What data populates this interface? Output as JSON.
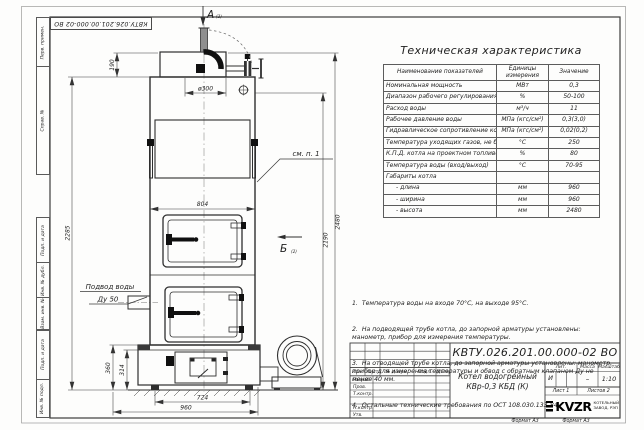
{
  "sheet": {
    "doc_number": "КВТУ.026.201.00.000-02  ВО",
    "format_label_1": "Формат А3",
    "format_label_2": "Формат А3",
    "margin_fields": [
      "Перв. примен.",
      "Справ. №",
      "Подп. и дата",
      "Инв. № дубл.",
      "Взам. инв. №",
      "Подп. и дата",
      "Инв. № подл."
    ]
  },
  "drawing": {
    "view_a_label": "А",
    "view_a_ref": "(2)",
    "view_b_label": "Б",
    "view_b_ref": "(2)",
    "callout": "см. п. 1",
    "water_inlet": {
      "line1": "Подвод воды",
      "line2": "Ду 50"
    },
    "dims": {
      "chimney_offset": "190",
      "flue_diameter": "ø300",
      "body_width": "804",
      "height_left": "2285",
      "height_total": "2480",
      "height_to_flue": "2190",
      "base_height": "360",
      "base_inner": "314",
      "base_width": "724",
      "depth": "960"
    }
  },
  "spec": {
    "title": "Техническая характеристика",
    "col_name": "Наименование показателей",
    "col_units": "Единицы измерения",
    "col_value": "Значение",
    "rows": [
      {
        "name": "Номинальная мощность",
        "units": "МВт",
        "value": "0,3"
      },
      {
        "name": "Диапазон рабочего регулирования",
        "units": "%",
        "value": "50-100"
      },
      {
        "name": "Расход воды",
        "units": "м³/ч",
        "value": "11"
      },
      {
        "name": "Рабочее давление воды",
        "units": "МПа (кгс/см²)",
        "value": "0,3(3,0)"
      },
      {
        "name": "Гидравлическое сопротивление котла",
        "units": "МПа (кгс/см²)",
        "value": "0,02(0,2)"
      },
      {
        "name": "Температура уходящих газов, не более",
        "units": "°С",
        "value": "250"
      },
      {
        "name": "К.П.Д. котла на проектном топливе",
        "units": "%",
        "value": "80"
      },
      {
        "name": "Температура воды (вход/выход)",
        "units": "°С",
        "value": "70-95"
      },
      {
        "name": "Габариты котла",
        "units": "",
        "value": ""
      },
      {
        "name": "- длина",
        "units": "мм",
        "value": "960"
      },
      {
        "name": "- ширина",
        "units": "мм",
        "value": "960"
      },
      {
        "name": "- высота",
        "units": "мм",
        "value": "2480"
      }
    ]
  },
  "notes": [
    "1.  Температура воды на входе 70°С, на выходе 95°С.",
    "2.  На подводящей трубе котла, до запорной арматуры установлены: манометр, прибор для измерения температуры.",
    "3.  На отводящей трубе котла, до запорной арматуры установлены: манометр, прибор для измерения температуры и обвод с обратным клапаном Ду не менее 40 мм.",
    "4.  Остальные технические требования по ОСТ 108.030.133-84."
  ],
  "title_block": {
    "doc_number": "КВТУ.026.201.00.000-02  ВО",
    "product_name_line1": "Котел водогрейный",
    "product_name_line2": "КВр-0,3 КБД (К)",
    "header_cols": [
      "Изм.",
      "Лист",
      "№ докум.",
      "Подп.",
      "Дата"
    ],
    "row_labels": [
      "Разраб.",
      "Пров.",
      "Т.контр.",
      "Н.контр.",
      "Утв."
    ],
    "lit_label": "Лит.",
    "lit_value": "И",
    "mass_label": "Масса",
    "mass_value": "–",
    "scale_label": "Масштаб",
    "scale_value": "1:10",
    "sheet_label": "Лист 1",
    "sheets_label": "Листов 2",
    "logo_text": "KVZR",
    "logo_tagline_line1": "КОТЕЛЬНЫЙ",
    "logo_tagline_line2": "ЗАВОД. РЭП"
  }
}
